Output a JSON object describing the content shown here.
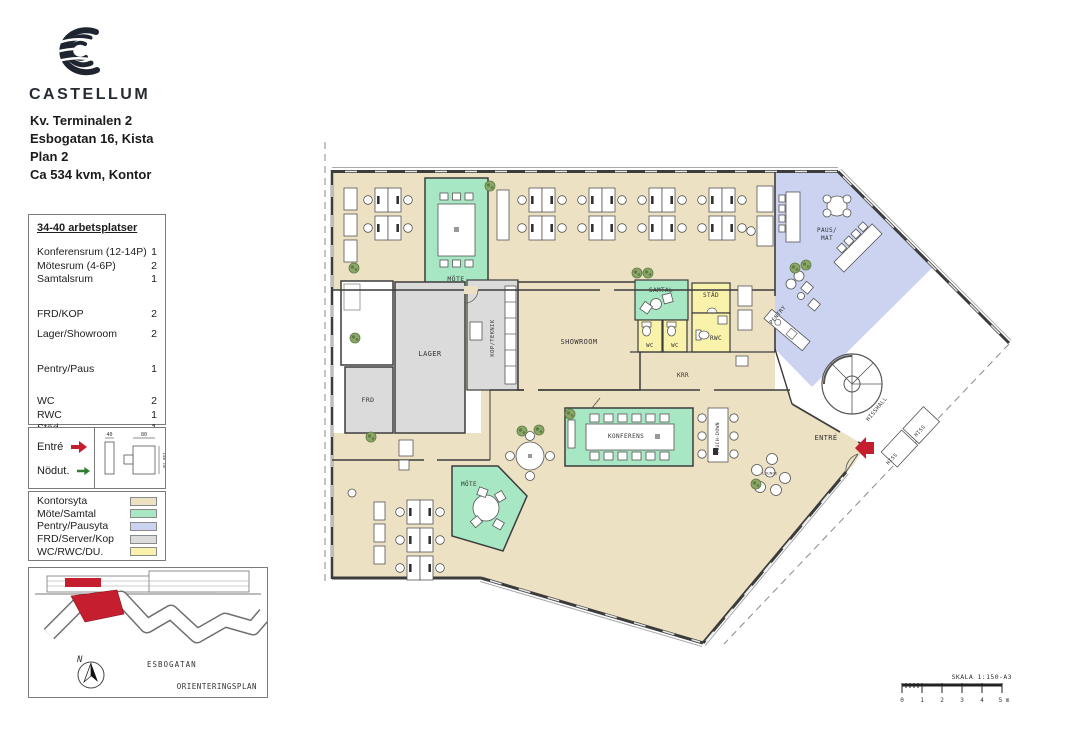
{
  "header": {
    "brand": "CASTELLUM",
    "address_lines": [
      "Kv. Terminalen 2",
      "Esbogatan 16, Kista",
      "Plan 2",
      "Ca 534 kvm, Kontor"
    ]
  },
  "program": {
    "title": "34-40 arbetsplatser",
    "rows": [
      {
        "label": "Konferensrum (12-14P)",
        "count": "1"
      },
      {
        "label": "Mötesrum (4-6P)",
        "count": "2"
      },
      {
        "label": "Samtalsrum",
        "count": "1"
      },
      {
        "label": "FRD/KOP",
        "count": "2"
      },
      {
        "label": "Lager/Showroom",
        "count": "2"
      },
      {
        "label": "Pentry/Paus",
        "count": "1"
      },
      {
        "label": "WC",
        "count": "2"
      },
      {
        "label": "RWC",
        "count": "1"
      },
      {
        "label": "Städ",
        "count": "1"
      }
    ]
  },
  "symbols": {
    "entre_label": "Entré",
    "nodut_label": "Nödut.",
    "dims": [
      "40",
      "80",
      "140 cm"
    ]
  },
  "area_legend": {
    "items": [
      {
        "label": "Kontorsyta",
        "color": "#EDE1C4"
      },
      {
        "label": "Möte/Samtal",
        "color": "#A8E7C3"
      },
      {
        "label": "Pentry/Pausyta",
        "color": "#CBD3F0"
      },
      {
        "label": "FRD/Server/Kop",
        "color": "#DBDBDB"
      },
      {
        "label": "WC/RWC/DU.",
        "color": "#F8F2AA"
      }
    ]
  },
  "orientation": {
    "north": "N",
    "street": "ESBOGATAN",
    "caption": "ORIENTERINGSPLAN"
  },
  "plan": {
    "rooms": {
      "mote_top": "MÖTE",
      "lager": "LAGER",
      "frd": "FRD",
      "kop": "KOP/TEKNIK",
      "showroom": "SHOWROOM",
      "samtal": "SAMTAL",
      "stad": "STÄD",
      "wc1": "WC",
      "wc2": "WC",
      "rwc": "RWC",
      "krr": "KRR",
      "paus1": "PAUS/",
      "paus2": "MAT",
      "pentry": "PENTRY",
      "konferens": "KONFERENS",
      "touchdown": "TOUCH-DOWN",
      "mote_bottom": "MÖTE",
      "entre": "ENTRÉ",
      "hisshall": "HISSHALL",
      "hiss1": "HISS",
      "hiss2": "HISS",
      "lounge": "LOUNGE"
    }
  },
  "scalebar": {
    "label": "SKALA 1:150-A3",
    "ticks": [
      "0",
      "1",
      "2",
      "3",
      "4",
      "5 m"
    ]
  },
  "colors": {
    "office_beige": "#EDE1C4",
    "meeting_green": "#A8E7C3",
    "pantry_blue": "#CBD3F0",
    "storage_gray": "#DBDBDB",
    "wc_yellow": "#F8F2AA",
    "wall": "#3C3C3C",
    "accent_red": "#C41E2F",
    "arrow_green": "#2F7D32"
  }
}
